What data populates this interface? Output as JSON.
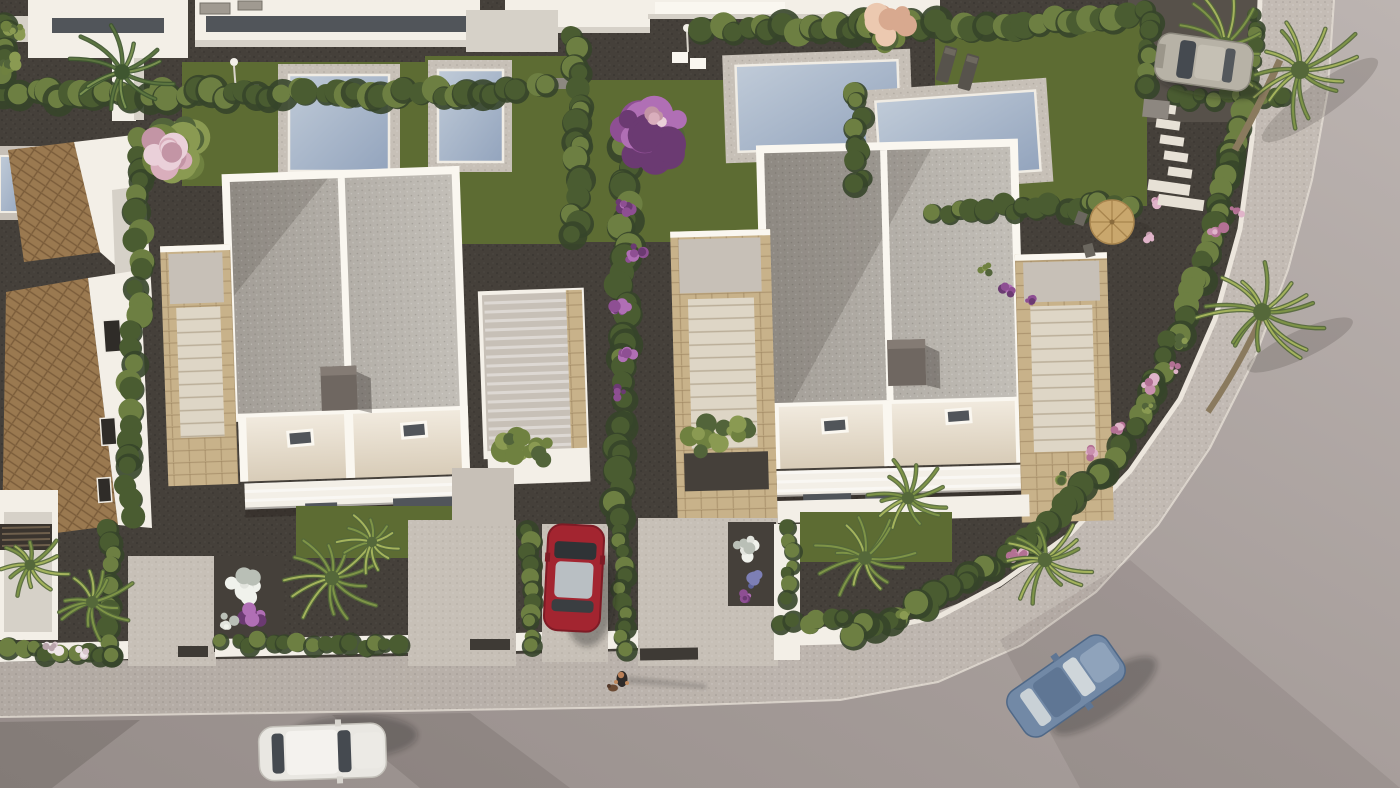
{
  "scene": {
    "type": "3d-architectural-rendering",
    "viewpoint": "aerial top-down, late-afternoon sun from the west casting shadows east",
    "description": "Aerial 3D render of a modern white villa development: two detached two-storey villas with gravel roof terraces, travertine stair towers and cream facades, four private swimming pools with grey decks in the rear gardens, cypress hedges dividing plots, palm trees and purple bougainvillea, a terracotta-tiled roof house on the left, concrete driveways with a parked red car and a silver SUV, a kerbed road curving around the corner with a white car parked and a blue car driving, and a person walking a small dog on the pavement.",
    "objects": [
      {
        "name": "villa-1",
        "detail": "white villa, speckled roof terrace, dark chimney, two skylights, travertine stair tower, east pergola terrace"
      },
      {
        "name": "villa-2",
        "detail": "white villa, speckled roof terrace, dark chimney, two skylights, two travertine stair towers"
      },
      {
        "name": "terracotta-house",
        "detail": "L-shaped house with clay tile roofs and white gable walls on left edge"
      },
      {
        "name": "pools",
        "detail": "4 rectangular private pools plus partial pool at far left, pale blue water, grey decks, outdoor showers"
      },
      {
        "name": "cars",
        "detail": "white car parked on road, blue car driving at the bend, red car in driveway, silver SUV in top-right drive"
      },
      {
        "name": "pedestrian",
        "detail": "person walking a small brown dog on the pavement, long shadow to the east"
      },
      {
        "name": "street",
        "detail": "smooth grey road wrapping the corner with speckled pavement band and white kerb walls"
      },
      {
        "name": "garden-furniture",
        "detail": "two sun loungers, round tan parasol with chairs, stepping-stone stairs"
      }
    ]
  },
  "colors": {
    "gravel": "#45403a",
    "gravelLight": "#57514a",
    "road": "#a59c99",
    "roadLight": "#bab2af",
    "roadDark": "#948b88",
    "sidewalk": "#bbb3ac",
    "curb": "#e9e3da",
    "grass": "#5d6c33",
    "grassLight": "#6f7d3b",
    "hedge": "#4a5c31",
    "hedgeDark": "#36452a",
    "hedgeLight": "#6d7f42",
    "shrub": "#6f8140",
    "shrubDark": "#52643a",
    "shrubLight": "#8a9a52",
    "poolWater": "#a3b2c6",
    "poolLight": "#c3cdd9",
    "deck": "#c7c0b7",
    "white": "#f3efe7",
    "whiteBright": "#faf7f0",
    "whiteShade": "#d6d1c8",
    "cream": "#efe8da",
    "creamShade": "#d5c9b6",
    "roofTop": "#bcb8b1",
    "roofShade": "#a19c95",
    "stone": "#c8b28a",
    "stoneDark": "#b49c74",
    "terra": "#9a7950",
    "terraDark": "#7a5c3a",
    "chimney": "#6f6761",
    "glass": "#51555a",
    "glassDark": "#34373a",
    "redCar": "#a32530",
    "redCarDark": "#7e1b25",
    "redCarGlass": "#b9bfc3",
    "blueCar": "#7289a6",
    "blueCarDark": "#3f5570",
    "blueCarLight": "#9db0c4",
    "silverCar": "#b7b2a6",
    "whiteCar": "#e9e7e2",
    "carGlass": "#454a50",
    "purple": "#8e4f93",
    "purpleDark": "#6b3a72",
    "purpleLight": "#b06fb5",
    "pinkFlower": "#c98fae",
    "pinkPale": "#d9c6cc",
    "blueFlower": "#7d7fb5",
    "peach": "#d8a98f",
    "flowerWhite": "#e2e4de",
    "palm": "#7e9447",
    "palmDark": "#55683a",
    "palmLight": "#a4b35c",
    "banana": "#5c7540",
    "bananaDark": "#3f5630",
    "bananaLight": "#7a9150",
    "trunk": "#8a7a5e",
    "parasol": "#c9a76d",
    "parasolRib": "#a8854e",
    "skin": "#b97f57",
    "shirt": "#2e2a28",
    "dog": "#6b4a33"
  }
}
